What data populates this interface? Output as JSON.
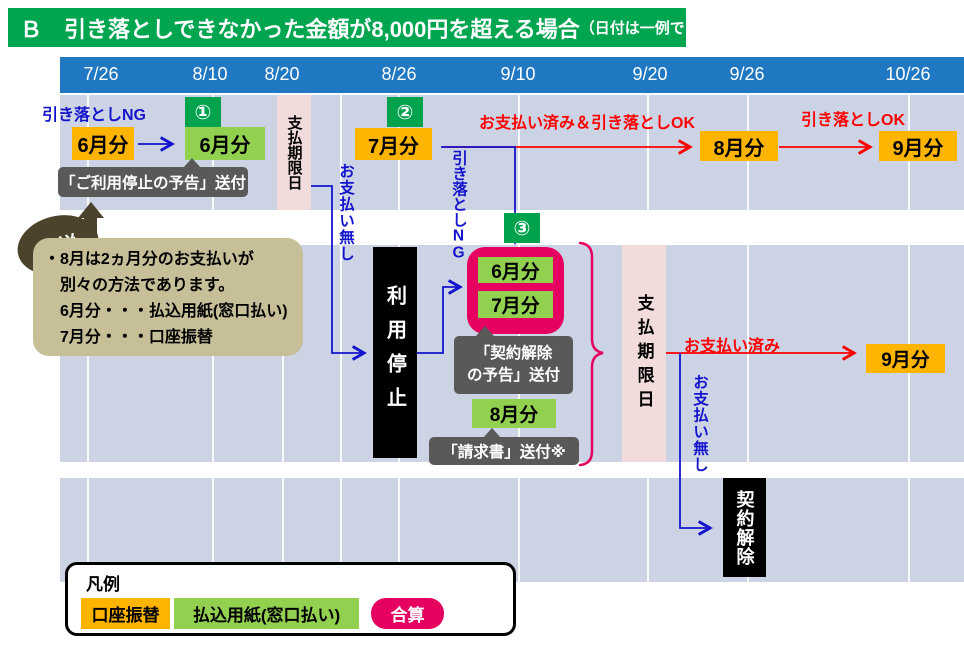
{
  "title": {
    "text": "Ｂ　引き落としできなかった金額が8,000円を超える場合",
    "suffix": "（日付は一例です。）"
  },
  "timeline": {
    "dates": [
      "7/26",
      "8/10",
      "8/20",
      "8/26",
      "9/10",
      "9/20",
      "9/26",
      "10/26"
    ]
  },
  "row1": {
    "ng_label": "引き落としNG",
    "jun_debit": "6月分",
    "badge1": "①",
    "jun_slip": "6月分",
    "notice_suspension": "「ご利用停止の予告」送付",
    "deadline": "支払期限日",
    "no_payment": "お支払い無し",
    "badge2": "②",
    "jul_debit": "7月分",
    "paid_and_ok": "お支払い済み＆引き落としOK",
    "ng_vertical": "引き落としNG",
    "aug_debit": "8月分",
    "ok_label": "引き落としOK",
    "sep_debit": "9月分"
  },
  "row2": {
    "suspension": "利用停止",
    "badge3": "③",
    "jun_slip": "6月分",
    "jul_slip": "7月分",
    "notice_termination_line1": "「契約解除",
    "notice_termination_line2": "の予告」送付",
    "aug_slip": "8月分",
    "invoice": "「請求書」送付※",
    "deadline": "支払期限日",
    "paid": "お支払い済み",
    "sep_debit": "9月分",
    "no_payment": "お支払い無し",
    "termination": "契約解除"
  },
  "callout": {
    "label": "解説",
    "lines": [
      "・8月は2ヵ月分のお支払いが",
      "　別々の方法であります。",
      "　6月分・・・払込用紙(窓口払い)",
      "　7月分・・・口座振替"
    ]
  },
  "legend": {
    "title": "凡例",
    "items": [
      {
        "label": "口座振替",
        "type": "account-debit"
      },
      {
        "label": "払込用紙(窓口払い)",
        "type": "payment-slip"
      },
      {
        "label": "合算",
        "type": "combined"
      }
    ]
  },
  "colors": {
    "title_green": "#00A550",
    "header_blue": "#1F78C1",
    "band": "#CCD3E4",
    "deadline_pink": "#F2DCDB",
    "debit_orange": "#FFB400",
    "slip_green": "#92D050",
    "badge_green": "#00A24D",
    "combined_magenta": "#E60060",
    "tooltip_gray": "#595959",
    "callout_tan": "#C7BF98",
    "callout_dark": "#4B432B",
    "line_blue": "#1414CC",
    "line_red": "#FF0000"
  }
}
